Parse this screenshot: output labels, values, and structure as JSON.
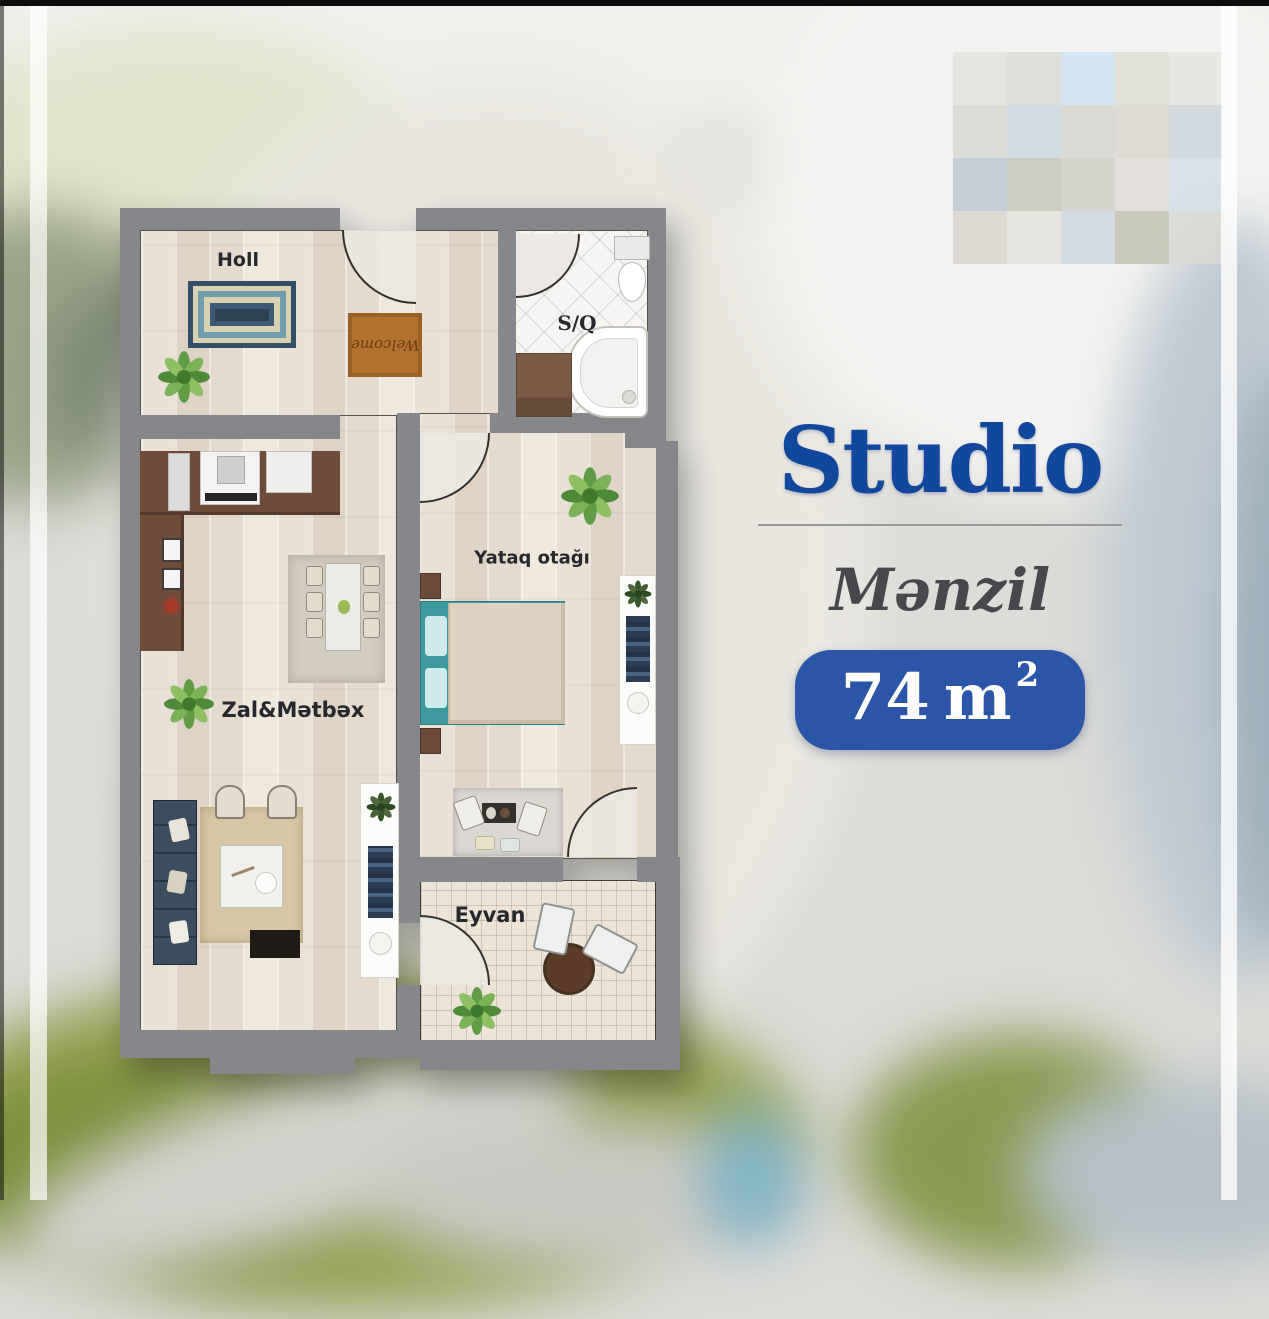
{
  "info_panel": {
    "title": "Studio",
    "subtitle": "Mənzil",
    "area": {
      "value": "74",
      "unit": "m",
      "superscript": "2"
    }
  },
  "floor_plan": {
    "rooms": {
      "hall": {
        "label": "Holl"
      },
      "bathroom": {
        "label": "S/Q"
      },
      "bedroom": {
        "label": "Yataq otağı"
      },
      "living_kitchen": {
        "label": "Zal&Mətbəx"
      },
      "balcony": {
        "label": "Eyvan"
      }
    },
    "doormat_text": "Welcome"
  },
  "colors": {
    "title_blue": "#11479d",
    "badge_blue": "#2b55a6",
    "wall_gray": "#85878b",
    "floor_wood": "#e6ddd2",
    "accent_teal": "#3f9aa0"
  }
}
